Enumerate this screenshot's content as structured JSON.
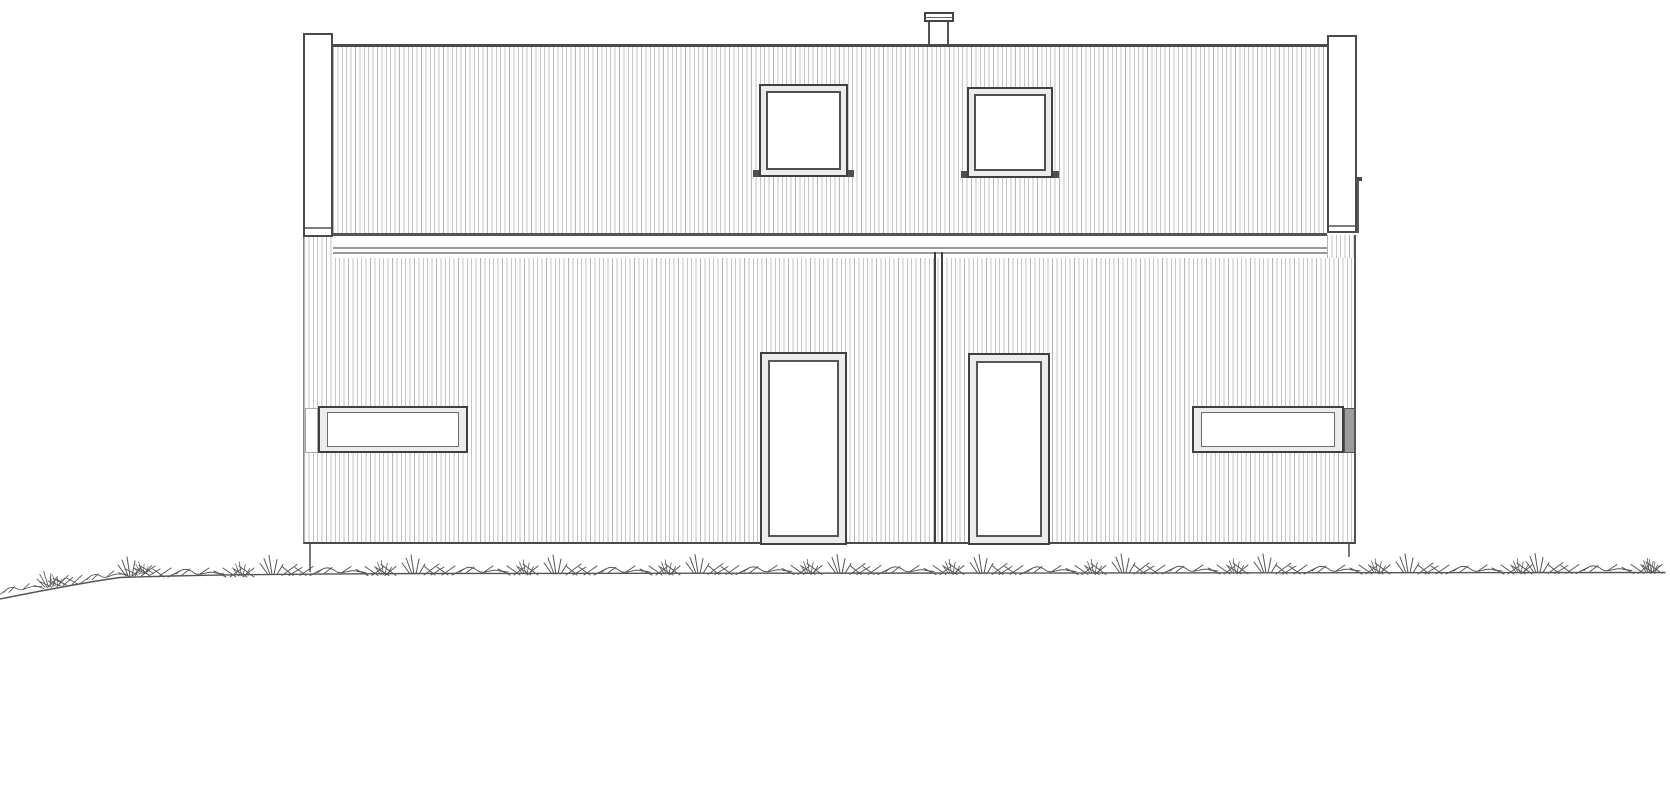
{
  "document": {
    "kind": "architectural elevation drawing",
    "view": "front elevation of a single-storey duplex house with clerestory band",
    "visible_text": "(none — the drawing contains no text, dimensions or labels)"
  },
  "palette": {
    "paper": "#ffffff",
    "line": "#454545",
    "line-strong": "#3f3f3f",
    "line-soft": "#9a9a9a",
    "hatch": "#c7c7c7",
    "hatch2": "#b5b5b5",
    "frame-fill": "#ececec",
    "glass": "#ffffff",
    "shade": "#9c9c9c",
    "ground": "#555555"
  },
  "components": {
    "left_corner_board": {
      "label": "Left corner board"
    },
    "right_corner_board": {
      "label": "Right corner board"
    },
    "roof_vent": {
      "label": "Roof vent / flue with cap"
    },
    "upper_window_left": {
      "label": "Upper square window (left)"
    },
    "upper_window_right": {
      "label": "Upper square window (right)"
    },
    "fascia_band": {
      "label": "Horizontal fascia / eaves band"
    },
    "party_wall_joint": {
      "label": "Central party-wall joint (double line)"
    },
    "entrance_door_left": {
      "label": "Entrance door (left unit)"
    },
    "entrance_door_right": {
      "label": "Entrance door (right unit)"
    },
    "strip_window_left": {
      "label": "Horizontal strip window (left)"
    },
    "strip_window_right": {
      "label": "Horizontal strip window (right, shaded corner return)"
    },
    "upper_cladding": {
      "label": "Vertical board cladding — upper band"
    },
    "lower_cladding": {
      "label": "Vertical board cladding — lower wall"
    },
    "ground_line": {
      "label": "Grade line with grass tufts"
    },
    "foundation_pier_left": {
      "label": "Foundation pier (left)"
    },
    "foundation_pier_right": {
      "label": "Foundation pier (right)"
    },
    "downpipe": {
      "label": "Edge line / downpipe right of corner board"
    }
  }
}
